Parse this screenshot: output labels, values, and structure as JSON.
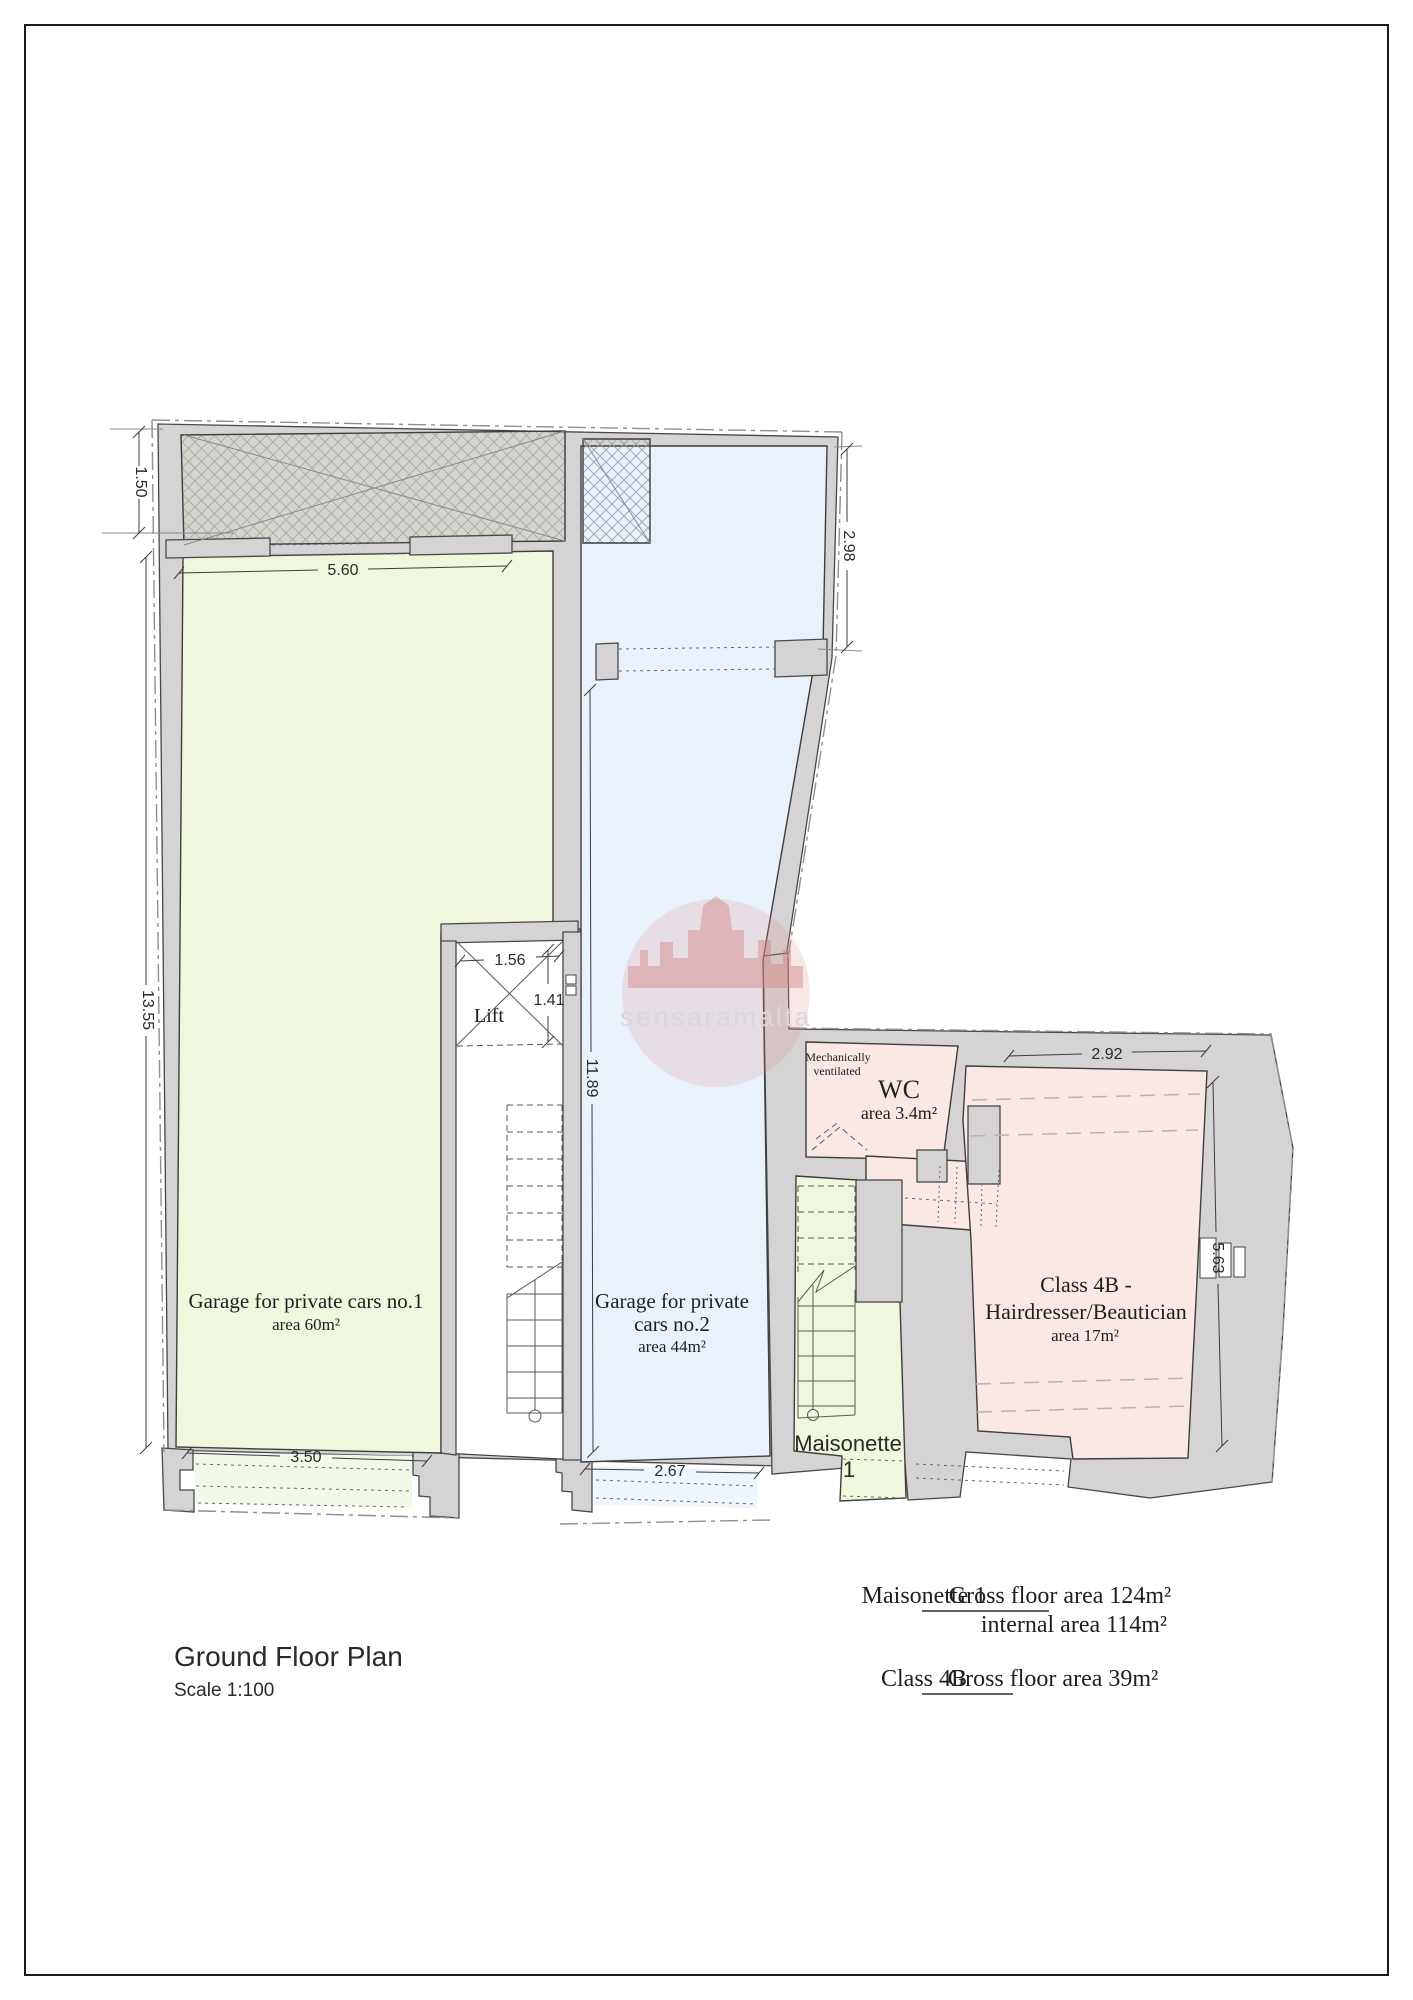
{
  "title_block": {
    "title": "Ground Floor Plan",
    "scale": "Scale 1:100"
  },
  "watermark": {
    "text": "sensaramalta"
  },
  "rooms": {
    "garage1": {
      "line1": "Garage for private cars no.1",
      "area": "area 60m²"
    },
    "garage2": {
      "line1": "Garage for private",
      "line2": "cars no.2",
      "area": "area 44m²"
    },
    "lift": {
      "label": "Lift"
    },
    "wc": {
      "vent_line1": "Mechanically",
      "vent_line2": "ventilated",
      "label": "WC",
      "area": "area 3.4m²"
    },
    "class4b": {
      "line1": "Class 4B -",
      "line2": "Hairdresser/Beautician",
      "area": "area 17m²"
    },
    "maisonette": {
      "line1": "Maisonette",
      "line2": "1"
    }
  },
  "dimensions": {
    "left_strip": "1.50",
    "garage1_top": "5.60",
    "garage2_right_top": "2.98",
    "garage1_left": "13.55",
    "lift_width": "1.56",
    "lift_depth": "1.41",
    "garage2_left": "11.89",
    "class4b_top": "2.92",
    "class4b_right": "5.63",
    "garage1_bottom": "3.50",
    "garage2_bottom": "2.67"
  },
  "legend": {
    "maisonette_label": "Maisonette 1",
    "maisonette_value1": "Gross floor area 124m²",
    "maisonette_value2": "internal area 114m²",
    "class4b_label": "Class 4B",
    "class4b_value": "Gross floor area 39m²"
  },
  "colors": {
    "garage_green": "#eff7dd",
    "garage_blue": "#e9f2fb",
    "room_pink": "#f9e8e4",
    "wall_gray": "#d5d3d3",
    "accent_red": "#cc2a1c",
    "watermark_red": "#dd9090"
  }
}
